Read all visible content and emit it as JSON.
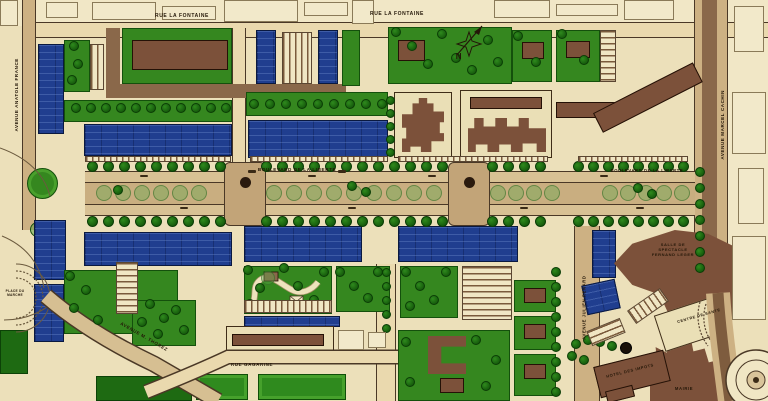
{
  "streets": {
    "rue_la_fontaine_west": "RUE LA FONTAINE",
    "rue_la_fontaine_east": "RUE LA FONTAINE",
    "avenue_anatole_france": "AVENUE ANATOLE FRANCE",
    "avenue_marcel_cachin": "AVENUE MARCEL CACHIN",
    "boulevard_de_la_liberte_west": "BOULEVARD DE LA LIBERTE",
    "boulevard_de_la_liberte_east": "BOULEVARD DE LA LIBERTE",
    "rue_gagarine": "RUE GAGARINE",
    "avenue_m_thorez": "AVENUE M. THOREZ",
    "avenue_julien_renard": "AVENUE JULIEN RENARD"
  },
  "places": {
    "salle_de_spectacle": "SALLE DE\nSPECTACLE\nFERNAND LEGER",
    "centre_de_sante": "CENTRE DE SANTE",
    "hotel_des_impots": "HOTEL DES IMPOTS",
    "mairie": "MAIRIE",
    "place_square": "PLACE DU\nMARCHE"
  },
  "compass": {
    "north": "N"
  },
  "colors": {
    "paper": "#ece0ba",
    "lawn_green": "#35871f",
    "residential_blue": "#203e8f",
    "civic_brown": "#7c513a",
    "road_tan": "#cdb183",
    "tree_green": "#1c6410"
  }
}
